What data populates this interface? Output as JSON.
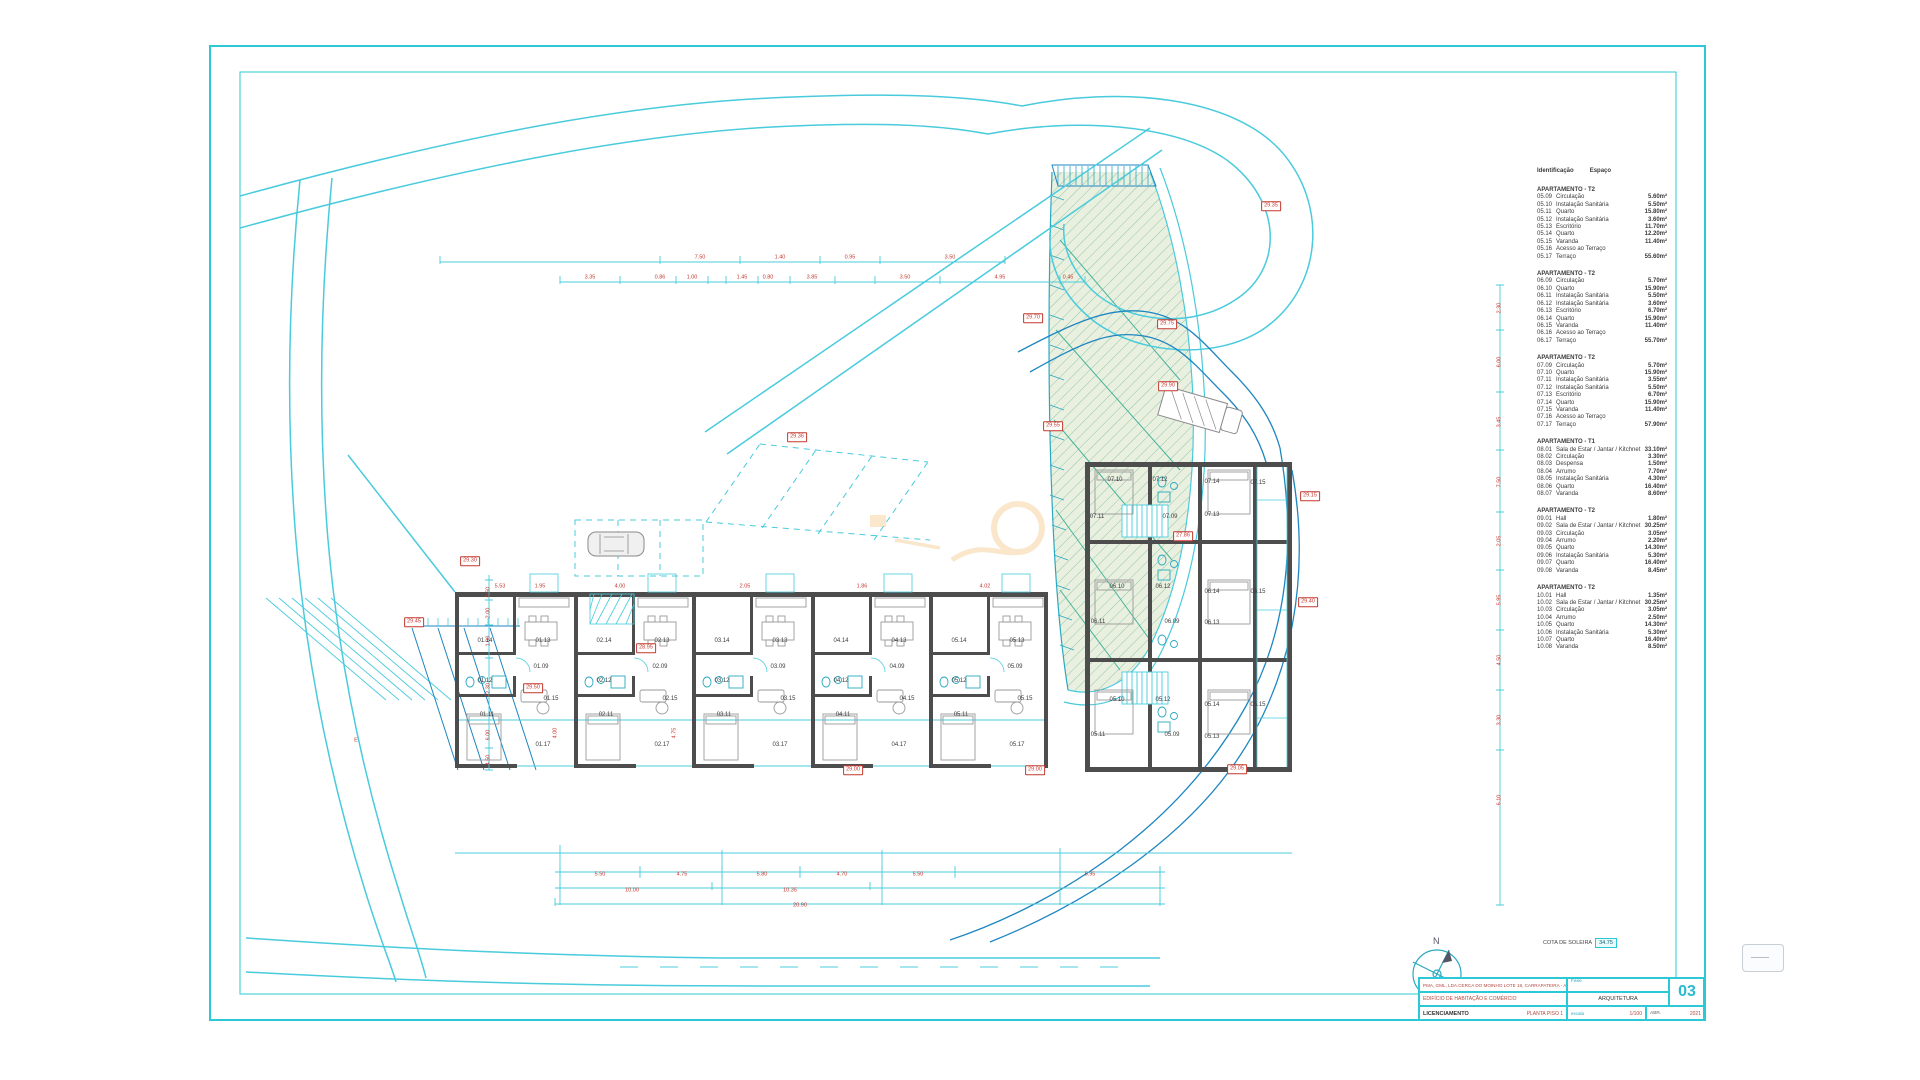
{
  "meta": {
    "north_label": "N",
    "cota_label": "COTA DE SOLEIRA",
    "cota_value": "34.75"
  },
  "colors": {
    "frame_cyan": "#2bc8d6",
    "road_cyan": "#49cbdc",
    "road_blue": "#1e86c0",
    "wall_gray": "#4d4d4d",
    "dim_red": "#c4382e",
    "green_fill": "#eaf0e0",
    "hatch_green": "#8fc7a6",
    "watermark_orange": "#efa33b"
  },
  "title_block": {
    "company": "PMA, GML, LDA.",
    "location": "CERCA DO MOINHO LOTE 18, CARRAPATEIRA - ALJEZUR",
    "fase_label": "Fase",
    "project": "EDIFÍCIO DE HABITAÇÃO E COMÉRCIO",
    "specialty": "ARQUITETURA",
    "phase": "LICENCIAMENTO",
    "drawing": "PLANTA PISO 1",
    "scale_label": "escala",
    "scale": "1/100",
    "date_month": "ABR.",
    "date_year": "2021",
    "sheet": "03"
  },
  "legend": {
    "header_id": "Identificação",
    "header_space": "Espaço",
    "sections": [
      {
        "title": "APARTAMENTO - T2",
        "rows": [
          [
            "05.09",
            "Circulação",
            "5.60m²"
          ],
          [
            "05.10",
            "Instalação Sanitária",
            "5.50m²"
          ],
          [
            "05.11",
            "Quarto",
            "15.80m²"
          ],
          [
            "05.12",
            "Instalação Sanitária",
            "3.60m²"
          ],
          [
            "05.13",
            "Escritório",
            "11.70m²"
          ],
          [
            "05.14",
            "Quarto",
            "12.20m²"
          ],
          [
            "05.15",
            "Varanda",
            "11.40m²"
          ],
          [
            "05.16",
            "Acesso ao Terraço",
            ""
          ],
          [
            "05.17",
            "Terraço",
            "55.60m²"
          ]
        ]
      },
      {
        "title": "APARTAMENTO - T2",
        "rows": [
          [
            "06.09",
            "Circulação",
            "5.70m²"
          ],
          [
            "06.10",
            "Quarto",
            "15.90m²"
          ],
          [
            "06.11",
            "Instalação Sanitária",
            "5.50m²"
          ],
          [
            "06.12",
            "Instalação Sanitária",
            "3.60m²"
          ],
          [
            "06.13",
            "Escritório",
            "6.70m²"
          ],
          [
            "06.14",
            "Quarto",
            "15.90m²"
          ],
          [
            "06.15",
            "Varanda",
            "11.40m²"
          ],
          [
            "06.16",
            "Acesso ao Terraço",
            ""
          ],
          [
            "06.17",
            "Terraço",
            "55.70m²"
          ]
        ]
      },
      {
        "title": "APARTAMENTO - T2",
        "rows": [
          [
            "07.09",
            "Circulação",
            "5.70m²"
          ],
          [
            "07.10",
            "Quarto",
            "15.90m²"
          ],
          [
            "07.11",
            "Instalação Sanitária",
            "3.55m²"
          ],
          [
            "07.12",
            "Instalação Sanitária",
            "5.50m²"
          ],
          [
            "07.13",
            "Escritório",
            "6.70m²"
          ],
          [
            "07.14",
            "Quarto",
            "15.90m²"
          ],
          [
            "07.15",
            "Varanda",
            "11.40m²"
          ],
          [
            "07.16",
            "Acesso ao Terraço",
            ""
          ],
          [
            "07.17",
            "Terraço",
            "57.90m²"
          ]
        ]
      },
      {
        "title": "APARTAMENTO - T1",
        "rows": [
          [
            "08.01",
            "Sala de Estar / Jantar / Kitchnet",
            "33.10m²"
          ],
          [
            "08.02",
            "Circulação",
            "3.30m²"
          ],
          [
            "08.03",
            "Despensa",
            "1.50m²"
          ],
          [
            "08.04",
            "Arrumo",
            "7.70m²"
          ],
          [
            "08.05",
            "Instalação Sanitária",
            "4.30m²"
          ],
          [
            "08.06",
            "Quarto",
            "16.40m²"
          ],
          [
            "08.07",
            "Varanda",
            "8.60m²"
          ]
        ]
      },
      {
        "title": "APARTAMENTO - T2",
        "rows": [
          [
            "09.01",
            "Hall",
            "1.80m²"
          ],
          [
            "09.02",
            "Sala de Estar / Jantar / Kitchnet",
            "30.25m²"
          ],
          [
            "09.03",
            "Circulação",
            "3.05m²"
          ],
          [
            "09.04",
            "Arrumo",
            "2.20m²"
          ],
          [
            "09.05",
            "Quarto",
            "14.30m²"
          ],
          [
            "09.06",
            "Instalação Sanitária",
            "5.30m²"
          ],
          [
            "09.07",
            "Quarto",
            "16.40m²"
          ],
          [
            "09.08",
            "Varanda",
            "8.45m²"
          ]
        ]
      },
      {
        "title": "APARTAMENTO - T2",
        "rows": [
          [
            "10.01",
            "Hall",
            "1.35m²"
          ],
          [
            "10.02",
            "Sala de Estar / Jantar / Kitchnet",
            "30.25m²"
          ],
          [
            "10.03",
            "Circulação",
            "3.05m²"
          ],
          [
            "10.04",
            "Arrumo",
            "2.50m²"
          ],
          [
            "10.05",
            "Quarto",
            "14.30m²"
          ],
          [
            "10.06",
            "Instalação Sanitária",
            "5.30m²"
          ],
          [
            "10.07",
            "Quarto",
            "16.40m²"
          ],
          [
            "10.08",
            "Varanda",
            "8.50m²"
          ]
        ]
      }
    ]
  },
  "badges": [
    {
      "x": 470,
      "y": 561,
      "v": "29.30"
    },
    {
      "x": 414,
      "y": 622,
      "v": "29.45"
    },
    {
      "x": 533,
      "y": 688,
      "v": "29.50"
    },
    {
      "x": 646,
      "y": 648,
      "v": "28.95"
    },
    {
      "x": 1033,
      "y": 318,
      "v": "29.70"
    },
    {
      "x": 1167,
      "y": 324,
      "v": "29.75"
    },
    {
      "x": 1168,
      "y": 386,
      "v": "29.90"
    },
    {
      "x": 1053,
      "y": 426,
      "v": "29.55"
    },
    {
      "x": 797,
      "y": 437,
      "v": "29.36"
    },
    {
      "x": 1271,
      "y": 206,
      "v": "29.35"
    },
    {
      "x": 1183,
      "y": 536,
      "v": "27.86"
    },
    {
      "x": 1310,
      "y": 496,
      "v": "29.15"
    },
    {
      "x": 1308,
      "y": 602,
      "v": "29.40"
    },
    {
      "x": 853,
      "y": 770,
      "v": "29.00"
    },
    {
      "x": 1035,
      "y": 770,
      "v": "29.00"
    },
    {
      "x": 1237,
      "y": 769,
      "v": "29.05"
    }
  ],
  "room_labels": [
    {
      "x": 485,
      "y": 641,
      "t": "01.14"
    },
    {
      "x": 543,
      "y": 641,
      "t": "01.13"
    },
    {
      "x": 485,
      "y": 681,
      "t": "01.12"
    },
    {
      "x": 487,
      "y": 715,
      "t": "01.11"
    },
    {
      "x": 541,
      "y": 667,
      "t": "01.09"
    },
    {
      "x": 551,
      "y": 699,
      "t": "01.15"
    },
    {
      "x": 543,
      "y": 745,
      "t": "01.17"
    },
    {
      "x": 604,
      "y": 641,
      "t": "02.14"
    },
    {
      "x": 662,
      "y": 641,
      "t": "02.13"
    },
    {
      "x": 604,
      "y": 681,
      "t": "02.12"
    },
    {
      "x": 606,
      "y": 715,
      "t": "02.11"
    },
    {
      "x": 660,
      "y": 667,
      "t": "02.09"
    },
    {
      "x": 670,
      "y": 699,
      "t": "02.15"
    },
    {
      "x": 662,
      "y": 745,
      "t": "02.17"
    },
    {
      "x": 722,
      "y": 641,
      "t": "03.14"
    },
    {
      "x": 780,
      "y": 641,
      "t": "03.13"
    },
    {
      "x": 722,
      "y": 681,
      "t": "03.12"
    },
    {
      "x": 724,
      "y": 715,
      "t": "03.11"
    },
    {
      "x": 778,
      "y": 667,
      "t": "03.09"
    },
    {
      "x": 788,
      "y": 699,
      "t": "03.15"
    },
    {
      "x": 780,
      "y": 745,
      "t": "03.17"
    },
    {
      "x": 841,
      "y": 641,
      "t": "04.14"
    },
    {
      "x": 899,
      "y": 641,
      "t": "04.13"
    },
    {
      "x": 841,
      "y": 681,
      "t": "04.12"
    },
    {
      "x": 843,
      "y": 715,
      "t": "04.11"
    },
    {
      "x": 897,
      "y": 667,
      "t": "04.09"
    },
    {
      "x": 907,
      "y": 699,
      "t": "04.15"
    },
    {
      "x": 899,
      "y": 745,
      "t": "04.17"
    },
    {
      "x": 959,
      "y": 641,
      "t": "05.14"
    },
    {
      "x": 1017,
      "y": 641,
      "t": "05.13"
    },
    {
      "x": 959,
      "y": 681,
      "t": "05.12"
    },
    {
      "x": 961,
      "y": 715,
      "t": "05.11"
    },
    {
      "x": 1015,
      "y": 667,
      "t": "05.09"
    },
    {
      "x": 1025,
      "y": 699,
      "t": "05.15"
    },
    {
      "x": 1017,
      "y": 745,
      "t": "05.17"
    },
    {
      "x": 1115,
      "y": 480,
      "t": "07.10"
    },
    {
      "x": 1160,
      "y": 480,
      "t": "07.12"
    },
    {
      "x": 1212,
      "y": 482,
      "t": "07.14"
    },
    {
      "x": 1258,
      "y": 483,
      "t": "07.15"
    },
    {
      "x": 1097,
      "y": 517,
      "t": "07.11"
    },
    {
      "x": 1170,
      "y": 517,
      "t": "07.09"
    },
    {
      "x": 1212,
      "y": 515,
      "t": "07.13"
    },
    {
      "x": 1117,
      "y": 587,
      "t": "06.10"
    },
    {
      "x": 1163,
      "y": 587,
      "t": "06.12"
    },
    {
      "x": 1212,
      "y": 592,
      "t": "06.14"
    },
    {
      "x": 1258,
      "y": 592,
      "t": "06.15"
    },
    {
      "x": 1098,
      "y": 622,
      "t": "06.11"
    },
    {
      "x": 1172,
      "y": 622,
      "t": "06.09"
    },
    {
      "x": 1212,
      "y": 623,
      "t": "06.13"
    },
    {
      "x": 1117,
      "y": 700,
      "t": "05.10"
    },
    {
      "x": 1163,
      "y": 700,
      "t": "05.12"
    },
    {
      "x": 1212,
      "y": 705,
      "t": "05.14"
    },
    {
      "x": 1258,
      "y": 705,
      "t": "05.15"
    },
    {
      "x": 1098,
      "y": 735,
      "t": "05.11"
    },
    {
      "x": 1172,
      "y": 735,
      "t": "05.09"
    },
    {
      "x": 1212,
      "y": 737,
      "t": "05.13"
    }
  ],
  "dim_numbers": [
    {
      "x": 700,
      "y": 258,
      "t": "7.50"
    },
    {
      "x": 780,
      "y": 258,
      "t": "1.40"
    },
    {
      "x": 850,
      "y": 258,
      "t": "0.95"
    },
    {
      "x": 950,
      "y": 258,
      "t": "3.50"
    },
    {
      "x": 590,
      "y": 278,
      "t": "3.35"
    },
    {
      "x": 660,
      "y": 278,
      "t": "0.86"
    },
    {
      "x": 692,
      "y": 278,
      "t": "1.00"
    },
    {
      "x": 742,
      "y": 278,
      "t": "1.45"
    },
    {
      "x": 768,
      "y": 278,
      "t": "0.80"
    },
    {
      "x": 812,
      "y": 278,
      "t": "3.85"
    },
    {
      "x": 905,
      "y": 278,
      "t": "3.50"
    },
    {
      "x": 1000,
      "y": 278,
      "t": "4.95"
    },
    {
      "x": 1068,
      "y": 278,
      "t": "0.45"
    },
    {
      "x": 600,
      "y": 875,
      "t": "5.50"
    },
    {
      "x": 682,
      "y": 875,
      "t": "4.75"
    },
    {
      "x": 762,
      "y": 875,
      "t": "5.80"
    },
    {
      "x": 842,
      "y": 875,
      "t": "4.70"
    },
    {
      "x": 918,
      "y": 875,
      "t": "5.50"
    },
    {
      "x": 1090,
      "y": 875,
      "t": "5.95"
    },
    {
      "x": 632,
      "y": 891,
      "t": "10.00"
    },
    {
      "x": 790,
      "y": 891,
      "t": "10.35"
    },
    {
      "x": 800,
      "y": 906,
      "t": "20.90"
    },
    {
      "x": 1500,
      "y": 308,
      "t": "2.30",
      "rot": 1
    },
    {
      "x": 1500,
      "y": 362,
      "t": "6.00",
      "rot": 1
    },
    {
      "x": 1500,
      "y": 422,
      "t": "3.45",
      "rot": 1
    },
    {
      "x": 1500,
      "y": 482,
      "t": "7.50",
      "rot": 1
    },
    {
      "x": 1500,
      "y": 541,
      "t": "2.05",
      "rot": 1
    },
    {
      "x": 1500,
      "y": 600,
      "t": "5.95",
      "rot": 1
    },
    {
      "x": 1500,
      "y": 660,
      "t": "4.50",
      "rot": 1
    },
    {
      "x": 1500,
      "y": 720,
      "t": "3.30",
      "rot": 1
    },
    {
      "x": 1500,
      "y": 800,
      "t": "6.10",
      "rot": 1
    },
    {
      "x": 489,
      "y": 592,
      "t": "0.50",
      "rot": 1
    },
    {
      "x": 489,
      "y": 613,
      "t": "2.00",
      "rot": 1
    },
    {
      "x": 489,
      "y": 641,
      "t": "1.90",
      "rot": 1
    },
    {
      "x": 489,
      "y": 690,
      "t": "12.30",
      "rot": 1
    },
    {
      "x": 489,
      "y": 735,
      "t": "6.00",
      "rot": 1
    },
    {
      "x": 489,
      "y": 760,
      "t": "4.50",
      "rot": 1
    },
    {
      "x": 500,
      "y": 587,
      "t": "5.53"
    },
    {
      "x": 540,
      "y": 587,
      "t": "1.95"
    },
    {
      "x": 620,
      "y": 587,
      "t": "4.00"
    },
    {
      "x": 745,
      "y": 587,
      "t": "2.05"
    },
    {
      "x": 862,
      "y": 587,
      "t": "1.86"
    },
    {
      "x": 985,
      "y": 587,
      "t": "4.02"
    },
    {
      "x": 556,
      "y": 733,
      "t": "4.00",
      "rot": 1
    },
    {
      "x": 675,
      "y": 733,
      "t": "4.75",
      "rot": 1
    },
    {
      "x": 356,
      "y": 741,
      "t": "E"
    }
  ]
}
